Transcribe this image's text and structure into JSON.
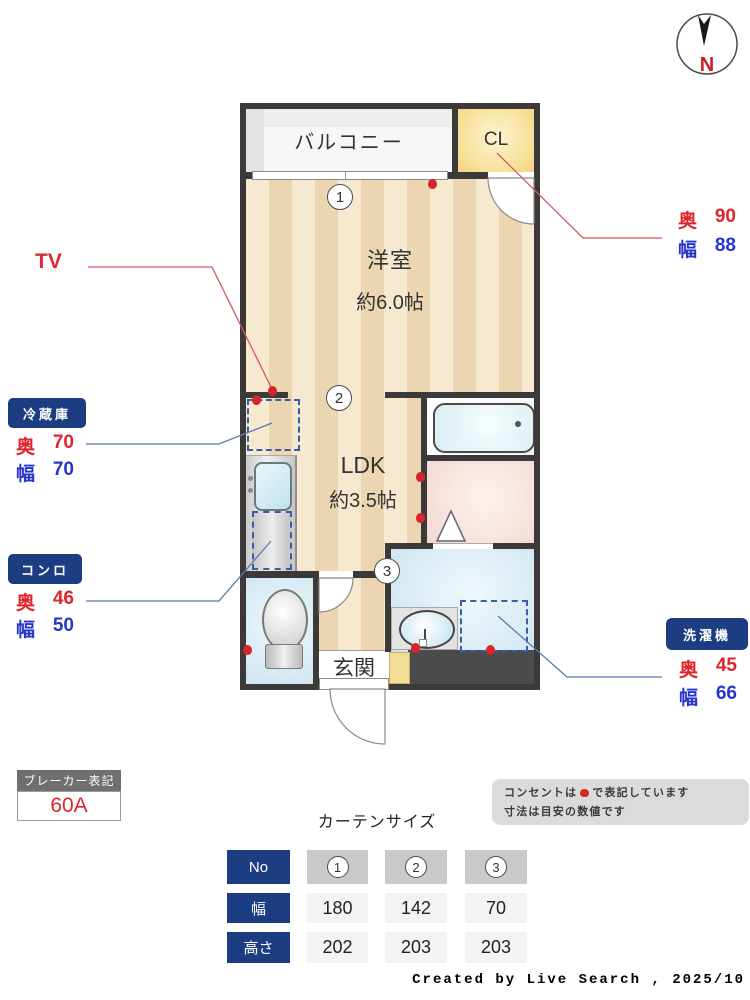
{
  "compass": {
    "north_label": "N"
  },
  "plan": {
    "balcony_label": "バルコニー",
    "closet_label": "CL",
    "western_room_name": "洋室",
    "western_room_size": "約6.0帖",
    "ldk_name": "LDK",
    "ldk_size": "約3.5帖",
    "entrance_label": "玄関",
    "marker1": "1",
    "marker2": "2",
    "marker3": "3"
  },
  "annotations": {
    "tv_label": "TV",
    "cl_dims": {
      "depth_label": "奥",
      "depth_value": "90",
      "width_label": "幅",
      "width_value": "88"
    },
    "fridge": {
      "title": "冷蔵庫",
      "depth_label": "奥",
      "depth_value": "70",
      "width_label": "幅",
      "width_value": "70"
    },
    "stove": {
      "title": "コンロ",
      "depth_label": "奥",
      "depth_value": "46",
      "width_label": "幅",
      "width_value": "50"
    },
    "washer": {
      "title": "洗濯機",
      "depth_label": "奥",
      "depth_value": "45",
      "width_label": "幅",
      "width_value": "66"
    }
  },
  "breaker": {
    "title": "ブレーカー表記",
    "value": "60A"
  },
  "note": {
    "line1_prefix": "コンセントは",
    "line1_suffix": "で表記しています",
    "line2": "寸法は目安の数値です"
  },
  "curtain_table": {
    "title": "カーテンサイズ",
    "corner_label": "No",
    "row_labels": [
      "幅",
      "高さ"
    ],
    "columns": [
      {
        "no": "1",
        "width": "180",
        "height": "202"
      },
      {
        "no": "2",
        "width": "142",
        "height": "203"
      },
      {
        "no": "3",
        "width": "70",
        "height": "203"
      }
    ]
  },
  "credit": "Created by Live Search , 2025/10",
  "colors": {
    "accent_navy": "#1d3d82",
    "dim_red": "#e0242c",
    "dim_blue": "#2636cc",
    "outlet_red": "#d6252c",
    "wall": "#3c3a38"
  }
}
